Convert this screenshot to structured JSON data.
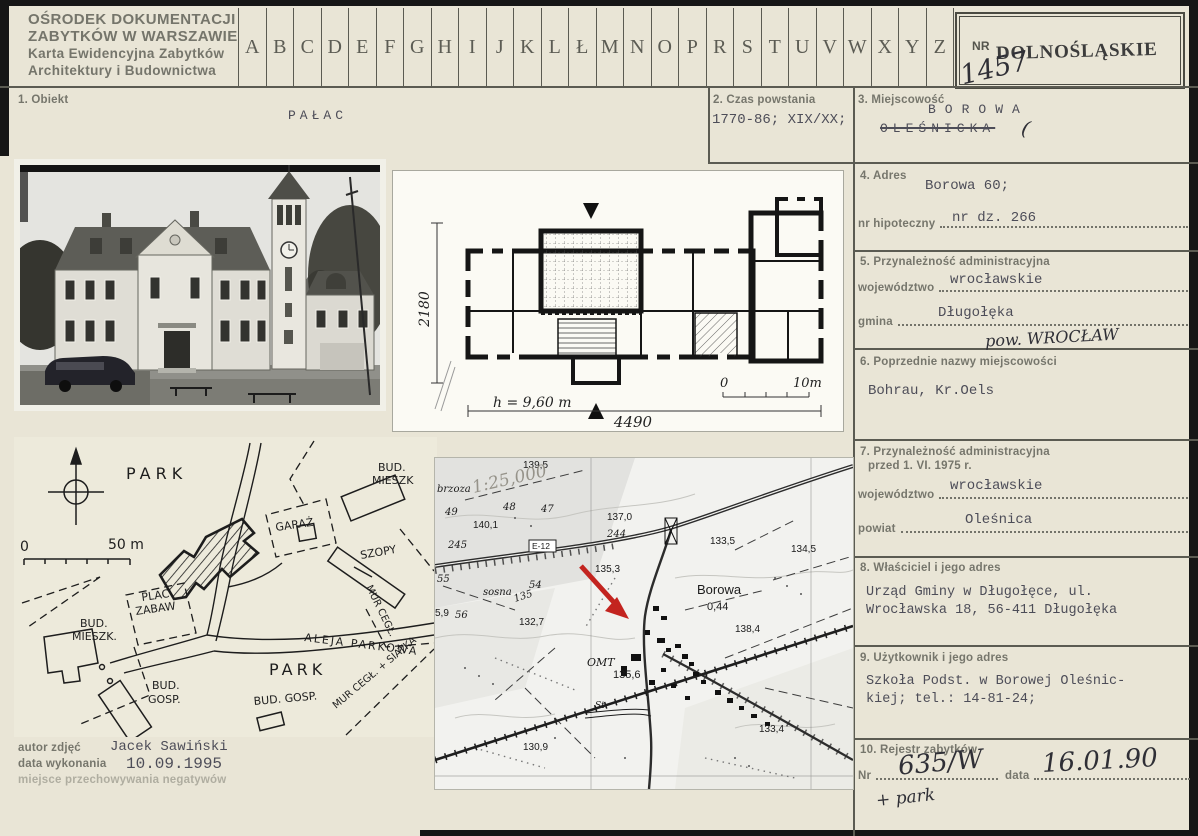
{
  "header": {
    "org_lines": [
      "OŚRODEK DOKUMENTACJI",
      "ZABYTKÓW W WARSZAWIE",
      "Karta Ewidencyjna Zabytków",
      "Architektury i Budownictwa"
    ],
    "alphabet": [
      "A",
      "B",
      "C",
      "D",
      "E",
      "F",
      "G",
      "H",
      "I",
      "J",
      "K",
      "L",
      "Ł",
      "M",
      "N",
      "O",
      "P",
      "R",
      "S",
      "T",
      "U",
      "V",
      "W",
      "X",
      "Y",
      "Z"
    ],
    "nr_label": "NR",
    "nr_value": "1457",
    "voivodeship_stamp": "DOLNOŚLĄSKIE"
  },
  "fields": {
    "obiekt": {
      "label": "1. Obiekt",
      "value": "PAŁAC"
    },
    "czas": {
      "label": "2. Czas powstania",
      "value": "1770-86; XIX/XX;"
    },
    "miejscowosc": {
      "label": "3. Miejscowość",
      "value": "BOROWA",
      "struck_value": "OLEŚNICKA",
      "mark": "("
    },
    "adres": {
      "label": "4. Adres",
      "value": "Borowa 60;",
      "nr_dz": "nr dz. 266",
      "nr_hipoteczny_label": "nr hipoteczny"
    },
    "przynaleznosc": {
      "label": "5. Przynależność administracyjna",
      "wojewodztwo_label": "województwo",
      "wojewodztwo": "wrocławskie",
      "gmina_label": "gmina",
      "gmina": "Długołęka",
      "handwritten": "pow. WROCŁAW"
    },
    "poprzednie": {
      "label": "6. Poprzednie nazwy miejscowości",
      "value": "Bohrau, Kr.Oels"
    },
    "przyn1975": {
      "label": "7. Przynależność administracyjna",
      "label2": "przed 1. VI. 1975 r.",
      "wojewodztwo_label": "województwo",
      "wojewodztwo": "wrocławskie",
      "powiat_label": "powiat",
      "powiat": "Oleśnica"
    },
    "wlasciciel": {
      "label": "8. Właściciel i jego adres",
      "line1": "Urząd Gminy w Długołęce, ul.",
      "line2": "Wrocławska 18, 56-411 Długołęka"
    },
    "uzytkownik": {
      "label": "9. Użytkownik i jego adres",
      "line1": "Szkoła Podst. w Borowej Oleśnic-",
      "line2": "kiej; tel.: 14-81-24;"
    },
    "rejestr": {
      "label": "10. Rejestr zabytków",
      "nr_label": "Nr",
      "nr_value": "635/W",
      "nr_extra": "+ park",
      "data_label": "data",
      "data_value": "16.01.90"
    }
  },
  "credits": {
    "autor_label": "autor zdjęć",
    "autor": "Jacek Sawiński",
    "data_label": "data wykonania",
    "data": "10.09.1995",
    "negatywy_label": "miejsce przechowywania negatywów"
  },
  "floorplan": {
    "dim_height": "2180",
    "dim_width": "4490",
    "height_note": "h = 9,60 m",
    "scale_0": "0",
    "scale_10": "10m"
  },
  "siteplan": {
    "labels": [
      {
        "text": "PARK"
      },
      {
        "text": "BUD."
      },
      {
        "text": "MIESZK"
      },
      {
        "text": "GARAŻ"
      },
      {
        "text": "SZOPY"
      },
      {
        "text": "MUR CEGŁ."
      },
      {
        "text": "PLAC"
      },
      {
        "text": "ZABAW"
      },
      {
        "text": "BUD."
      },
      {
        "text": "MIESZK."
      },
      {
        "text": "BUD."
      },
      {
        "text": "GOSP."
      },
      {
        "text": "ALEJA PARKOWA"
      },
      {
        "text": "PARK"
      },
      {
        "text": "BUD. GOSP."
      },
      {
        "text": "MUR CEGŁ. + SIATKA"
      },
      {
        "text": "0"
      },
      {
        "text": "50 m"
      }
    ]
  },
  "map": {
    "labels": [
      {
        "text": "brzoza"
      },
      {
        "text": "139,5"
      },
      {
        "text": "49"
      },
      {
        "text": "48"
      },
      {
        "text": "47"
      },
      {
        "text": "140,1"
      },
      {
        "text": "245"
      },
      {
        "text": "E-12"
      },
      {
        "text": "137,0"
      },
      {
        "text": "244"
      },
      {
        "text": "135,3"
      },
      {
        "text": "133,5"
      },
      {
        "text": "134,5"
      },
      {
        "text": "sosna"
      },
      {
        "text": "54"
      },
      {
        "text": "135"
      },
      {
        "text": "55"
      },
      {
        "text": "5,9"
      },
      {
        "text": "56"
      },
      {
        "text": "132,7"
      },
      {
        "text": "Borowa"
      },
      {
        "text": "0,44"
      },
      {
        "text": "138,4"
      },
      {
        "text": "OMT"
      },
      {
        "text": "135,6"
      },
      {
        "text": "St."
      },
      {
        "text": "133,4"
      },
      {
        "text": "130,9"
      },
      {
        "text": "1:25,000"
      }
    ]
  }
}
